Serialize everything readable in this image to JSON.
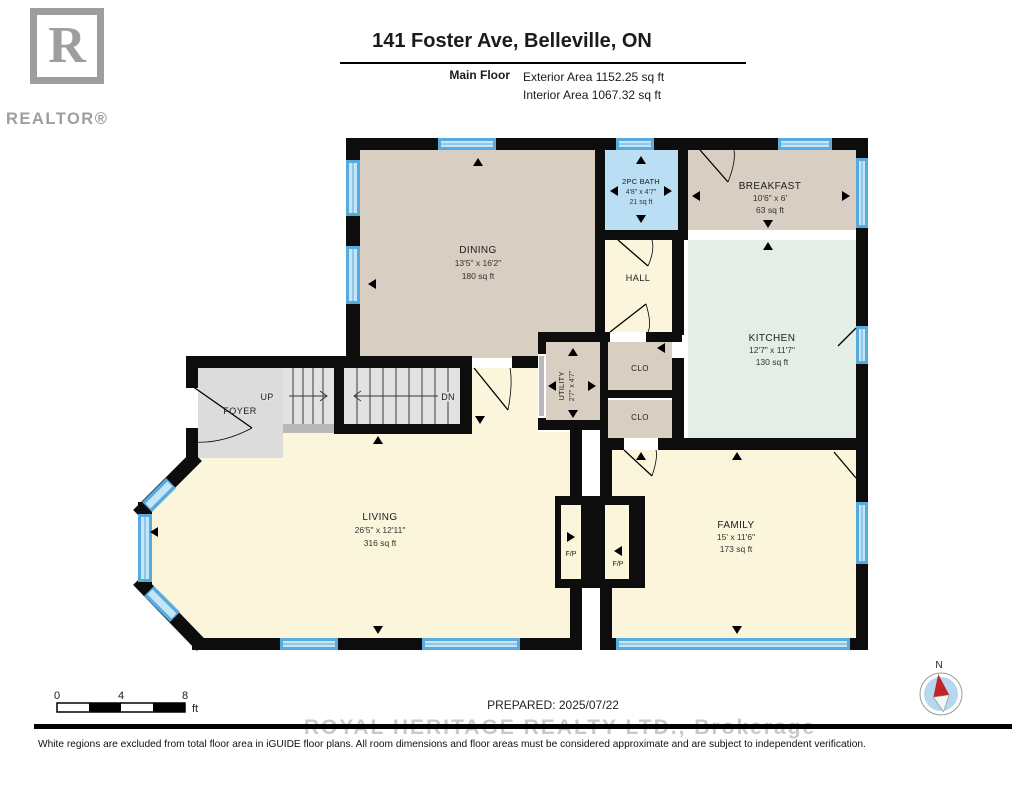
{
  "header": {
    "logo_r": "R",
    "logo_text": "REALTOR®",
    "title": "141 Foster Ave, Belleville, ON",
    "floor_label": "Main Floor",
    "exterior_area": "Exterior Area 1152.25 sq ft",
    "interior_area": "Interior Area 1067.32 sq ft"
  },
  "rooms": [
    {
      "name": "DINING",
      "dims": "13'5\" x 16'2\"",
      "area": "180 sq ft"
    },
    {
      "name": "2PC BATH",
      "dims": "4'8\" x 4'7\"",
      "area": "21 sq ft"
    },
    {
      "name": "BREAKFAST",
      "dims": "10'6\" x 6'",
      "area": "63 sq ft"
    },
    {
      "name": "KITCHEN",
      "dims": "12'7\" x 11'7\"",
      "area": "130 sq ft"
    },
    {
      "name": "HALL"
    },
    {
      "name": "CLO"
    },
    {
      "name": "CLO"
    },
    {
      "name": "UTILITY",
      "dims": "2'7\" x 4'7\""
    },
    {
      "name": "FOYER"
    },
    {
      "name": "LIVING",
      "dims": "26'5\" x 12'11\"",
      "area": "316 sq ft"
    },
    {
      "name": "FAMILY",
      "dims": "15' x 11'6\"",
      "area": "173 sq ft"
    }
  ],
  "labels": {
    "up": "UP",
    "dn": "DN",
    "fp": "F/P"
  },
  "footer": {
    "scale_0": "0",
    "scale_4": "4",
    "scale_8": "8",
    "scale_unit": "ft",
    "prepared": "PREPARED: 2025/07/22",
    "watermark": "ROYAL HERITAGE REALTY LTD., Brokerage",
    "disclaimer": "White regions are excluded from total floor area in iGUIDE floor plans. All room dimensions and floor areas must be considered approximate and are subject to independent verification.",
    "compass_north": "N"
  },
  "colors": {
    "wall": "#0d0d0d",
    "tan": "#d8cec2",
    "bath_blue": "#badef4",
    "kitchen_mint": "#e4eee6",
    "cream": "#fbf5dc",
    "foyer_gray": "#dcdcdc",
    "stair_gray": "#e2e2e2",
    "window_blue": "#58abdf",
    "window_light": "#c6e5f7",
    "compass_blue": "#b5d8ef",
    "needle_red": "#c32427",
    "logo_gray": "#9e9e9e",
    "watermark_gray": "#c9c9c9"
  }
}
